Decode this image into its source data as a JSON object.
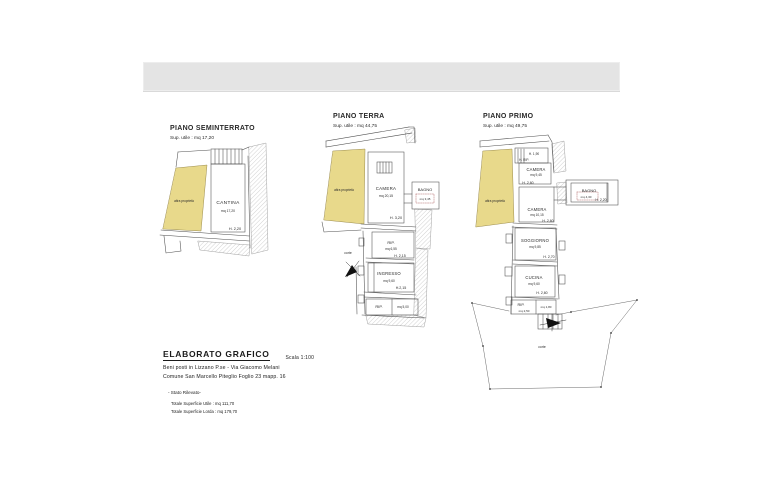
{
  "colors": {
    "property_fill": "#e8d98b",
    "area_text": "#aa5c5c",
    "line": "#4d4d4d"
  },
  "plans": [
    {
      "title": "PIANO SEMINTERRATO",
      "subtitle": "Sup. utile : mq 17,20",
      "other_property": "altra proprietà",
      "rooms": [
        {
          "name": "CANTINA",
          "area": "mq 17,20",
          "height": "H. 2,20"
        }
      ]
    },
    {
      "title": "PIANO TERRA",
      "subtitle": "Sup. utile : mq 44,75",
      "other_property": "altra proprietà",
      "court": "corte",
      "rooms": [
        {
          "name": "CAMERA",
          "area": "mq 20,15",
          "height": "H. 3,20"
        },
        {
          "name": "BAGNO",
          "area": "mq 3,45"
        },
        {
          "name": "RIP.",
          "area": "mq 6,55",
          "height": "H. 2,15"
        },
        {
          "name": "INGRESSO",
          "area": "mq 9,60",
          "height": "H.2,15"
        },
        {
          "name": "RIP.",
          "area": "mq 5,00"
        }
      ]
    },
    {
      "title": "PIANO PRIMO",
      "subtitle": "Sup. utile : mq 49,75",
      "other_property": "altra proprietà",
      "court": "corte",
      "attic_height": "H. 1,90",
      "attic_label": "H. RIP.",
      "rooms": [
        {
          "name": "CAMERA",
          "area": "mq 9,45",
          "height": "H. 2,60"
        },
        {
          "name": "BAGNO",
          "area": "mq 4,30",
          "height": "H. 2,20"
        },
        {
          "name": "CAMERA",
          "area": "mq 10,15",
          "height": "H. 2,60"
        },
        {
          "name": "SOGGIORNO",
          "area": "mq 9,85",
          "height": "H. 2,70"
        },
        {
          "name": "CUCINA",
          "area": "mq 9,60",
          "height": "H. 2,60"
        },
        {
          "name": "RIP.",
          "area": "mq 2,50",
          "area2": "mq 1,80"
        }
      ]
    }
  ],
  "title_block": {
    "title": "ELABORATO GRAFICO",
    "scale": "Scala 1:100",
    "line1": "Beni posti in Lizzano P.se - Via Giacomo Melani",
    "line2": "Comune San Marcello Piteglio Foglio 23 mapp. 16",
    "state": "- Stato Rilevato-",
    "total_net": "Totale Superficie Utile : mq 111,70",
    "total_gross": "Totale Superficie Lorda : mq 179,70"
  }
}
